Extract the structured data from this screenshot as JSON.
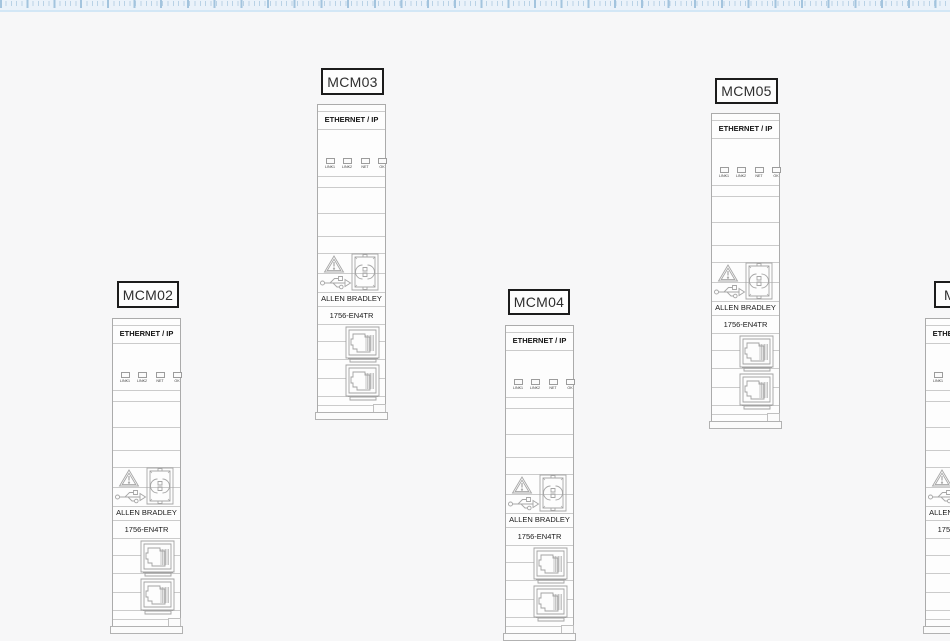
{
  "page": {
    "background_color": "#f7f7f8",
    "outline_color": "#ababab",
    "tag_border_color": "#1c1c1c"
  },
  "ruler": {
    "background_color": "#eaf2fa",
    "minor_tick_color": "#b9d2e6",
    "major_tick_color": "#a3c4de"
  },
  "devices": {
    "shared": {
      "title": "ETHERNET / IP",
      "brand": "ALLEN BRADLEY",
      "model": "1756-EN4TR",
      "leds": [
        "LINK1",
        "LINK2",
        "NET",
        "OK"
      ],
      "icons": [
        "warning-triangle-icon",
        "sd-card-icon",
        "usb-icon",
        "ethernet-port-icon",
        "ethernet-port-icon"
      ]
    },
    "tags": [
      "MCM02",
      "MCM03",
      "MCM04",
      "MCM05",
      "MCM06"
    ]
  }
}
